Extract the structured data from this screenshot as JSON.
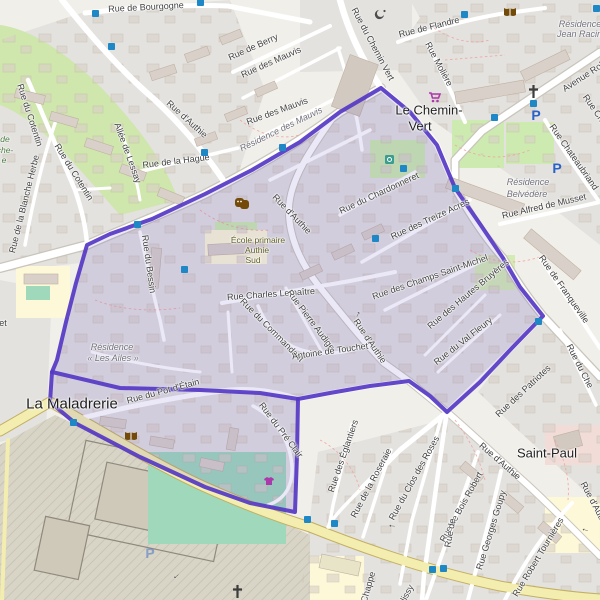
{
  "map_title": "Quartier boundary map (OSM style)",
  "boundary": {
    "stroke": "#5538c5",
    "fill": "rgba(100,80,200,0.14)",
    "outer_points": "381,88 340,112 300,142 252,170 205,194 152,219 110,234 87,245 76,283 66,322 57,360 52,372 50,402 75,423 140,457 205,487 250,503 295,512 297,455 298,399 330,393 370,386 409,381 430,396 447,412 480,382 512,348 543,316 520,287 503,258 480,224 455,188 437,145 410,112",
    "inner_edge_points": "52,372 120,388 200,390 260,393 298,399"
  },
  "labels": [
    {
      "text": "Rue de Bourgogne",
      "x": 146,
      "y": 7,
      "rot": -3,
      "cls": "street"
    },
    {
      "text": "Rue de Berry",
      "x": 253,
      "y": 47,
      "rot": -24,
      "cls": "street"
    },
    {
      "text": "Rue des Mauvis",
      "x": 271,
      "y": 62,
      "rot": -24,
      "cls": "street"
    },
    {
      "text": "Rue des Mauvis",
      "x": 277,
      "y": 111,
      "rot": -20,
      "cls": "street"
    },
    {
      "text": "Résidence des Mauvis",
      "x": 281,
      "y": 129,
      "rot": -26,
      "cls": "residence"
    },
    {
      "text": "Rue du Chemin Vert",
      "x": 373,
      "y": 44,
      "rot": 62,
      "cls": "street"
    },
    {
      "text": "Rue de Flandre",
      "x": 429,
      "y": 27,
      "rot": -14,
      "cls": "street"
    },
    {
      "text": "Rue Molière",
      "x": 439,
      "y": 64,
      "rot": 62,
      "cls": "street"
    },
    {
      "text": "Avenue Rob",
      "x": 584,
      "y": 76,
      "rot": -33,
      "cls": "street"
    },
    {
      "text": "Résidence",
      "x": 580,
      "y": 24,
      "rot": 0,
      "cls": "residence"
    },
    {
      "text": "Jean Racine",
      "x": 582,
      "y": 34,
      "rot": 0,
      "cls": "residence"
    },
    {
      "text": "Rue Chateaubriand",
      "x": 574,
      "y": 157,
      "rot": 55,
      "cls": "street"
    },
    {
      "text": "Rue Charle",
      "x": 598,
      "y": 114,
      "rot": 55,
      "cls": "street"
    },
    {
      "text": "Rue Alfred de Musset",
      "x": 544,
      "y": 206,
      "rot": -13,
      "cls": "street"
    },
    {
      "text": "Résidence",
      "x": 528,
      "y": 182,
      "rot": 0,
      "cls": "residence"
    },
    {
      "text": "Belvédère",
      "x": 527,
      "y": 194,
      "rot": 0,
      "cls": "residence"
    },
    {
      "text": "Rue d'Authie",
      "x": 187,
      "y": 119,
      "rot": 42,
      "cls": "street"
    },
    {
      "text": "Rue de la Hague",
      "x": 176,
      "y": 161,
      "rot": -7,
      "cls": "street"
    },
    {
      "text": "Allée de Lessay",
      "x": 128,
      "y": 153,
      "rot": 70,
      "cls": "street"
    },
    {
      "text": "Rue du Cotentin",
      "x": 30,
      "y": 115,
      "rot": 72,
      "cls": "street"
    },
    {
      "text": "Rue du Cotentin",
      "x": 74,
      "y": 172,
      "rot": 58,
      "cls": "street"
    },
    {
      "text": "Rue de la Blanche Herbe",
      "x": 24,
      "y": 204,
      "rot": -76,
      "cls": "street"
    },
    {
      "text": "Rue du Bessin",
      "x": 149,
      "y": 264,
      "rot": 82,
      "cls": "street"
    },
    {
      "text": "Rue d'Authie",
      "x": 292,
      "y": 214,
      "rot": 46,
      "cls": "street"
    },
    {
      "text": "Rue du Chardonneret",
      "x": 379,
      "y": 193,
      "rot": -25,
      "cls": "street"
    },
    {
      "text": "Rue des Treize Acres",
      "x": 430,
      "y": 219,
      "rot": -25,
      "cls": "street"
    },
    {
      "text": "Rue des Champs Saint-Michel",
      "x": 430,
      "y": 277,
      "rot": -19,
      "cls": "street"
    },
    {
      "text": "Rue des Hautes Bruyères",
      "x": 468,
      "y": 294,
      "rot": -40,
      "cls": "street"
    },
    {
      "text": "Rue du Val Fleury",
      "x": 463,
      "y": 341,
      "rot": -38,
      "cls": "street"
    },
    {
      "text": "Rue Charles Lemaître",
      "x": 271,
      "y": 294,
      "rot": -4,
      "cls": "street"
    },
    {
      "text": "Rue Pierre Audige",
      "x": 311,
      "y": 320,
      "rot": 53,
      "cls": "street"
    },
    {
      "text": "Rue du Commandant",
      "x": 272,
      "y": 330,
      "rot": 45,
      "cls": "street"
    },
    {
      "text": "Antoine de Touchet",
      "x": 330,
      "y": 351,
      "rot": -8,
      "cls": "street"
    },
    {
      "text": "Rue d'Authie",
      "x": 370,
      "y": 341,
      "rot": 56,
      "cls": "street"
    },
    {
      "text": "École primaire",
      "x": 258,
      "y": 240,
      "rot": 0,
      "cls": "school"
    },
    {
      "text": "Authie",
      "x": 257,
      "y": 250,
      "rot": 0,
      "cls": "school"
    },
    {
      "text": "Sud",
      "x": 253,
      "y": 260,
      "rot": 0,
      "cls": "school"
    },
    {
      "text": "Résidence",
      "x": 112,
      "y": 347,
      "rot": 0,
      "cls": "residence"
    },
    {
      "text": "« Les Ailes »",
      "x": 113,
      "y": 358,
      "rot": 0,
      "cls": "residence"
    },
    {
      "text": "Rue du Pot d'Étain",
      "x": 163,
      "y": 391,
      "rot": -15,
      "cls": "street"
    },
    {
      "text": "La Maladrerie",
      "x": 72,
      "y": 404,
      "rot": 0,
      "cls": "place-lg"
    },
    {
      "text": "Le Chemin-",
      "x": 429,
      "y": 110,
      "rot": 0,
      "cls": "place"
    },
    {
      "text": "Vert",
      "x": 420,
      "y": 126,
      "rot": 0,
      "cls": "place"
    },
    {
      "text": "Saint-Paul",
      "x": 547,
      "y": 453,
      "rot": 0,
      "cls": "place"
    },
    {
      "text": "Rue du Pré Clair",
      "x": 281,
      "y": 430,
      "rot": 53,
      "cls": "street"
    },
    {
      "text": "Rue des Églantiers",
      "x": 343,
      "y": 456,
      "rot": -71,
      "cls": "street"
    },
    {
      "text": "Rue de la Roseraie",
      "x": 371,
      "y": 483,
      "rot": -62,
      "cls": "street"
    },
    {
      "text": "Rue du Clos des Roses",
      "x": 414,
      "y": 478,
      "rot": -61,
      "cls": "street"
    },
    {
      "text": "Rue des Patriotes",
      "x": 523,
      "y": 391,
      "rot": -43,
      "cls": "street"
    },
    {
      "text": "Rue de Franqueville",
      "x": 564,
      "y": 289,
      "rot": 55,
      "cls": "street"
    },
    {
      "text": "Rue du Che",
      "x": 580,
      "y": 366,
      "rot": 63,
      "cls": "street"
    },
    {
      "text": "Rue de Bois Robert",
      "x": 461,
      "y": 507,
      "rot": -61,
      "cls": "street"
    },
    {
      "text": "Rue Georges Goupy",
      "x": 491,
      "y": 530,
      "rot": -73,
      "cls": "street"
    },
    {
      "text": "Rue Robert Tournières",
      "x": 538,
      "y": 557,
      "rot": -59,
      "cls": "street"
    },
    {
      "text": "Rue d'Authie",
      "x": 500,
      "y": 461,
      "rot": 41,
      "cls": "street"
    },
    {
      "text": "Rue d'Authie",
      "x": 595,
      "y": 505,
      "rot": 62,
      "cls": "street"
    },
    {
      "text": "Chappe",
      "x": 368,
      "y": 587,
      "rot": -74,
      "cls": "street"
    },
    {
      "text": "lissy",
      "x": 407,
      "y": 593,
      "rot": -62,
      "cls": "street"
    },
    {
      "text": "Rue de",
      "x": 450,
      "y": 533,
      "rot": -80,
      "cls": "street"
    },
    {
      "text": "de",
      "x": 5,
      "y": 139,
      "rot": 0,
      "cls": "park"
    },
    {
      "text": "che-",
      "x": 5,
      "y": 150,
      "rot": 0,
      "cls": "park"
    },
    {
      "text": "e",
      "x": 4,
      "y": 160,
      "rot": 0,
      "cls": "park"
    },
    {
      "text": "et",
      "x": 3,
      "y": 323,
      "rot": 0,
      "cls": "street"
    }
  ],
  "bus_stops": [
    [
      95,
      13
    ],
    [
      200,
      2
    ],
    [
      111,
      46
    ],
    [
      464,
      14
    ],
    [
      596,
      8
    ],
    [
      282,
      147
    ],
    [
      204,
      152
    ],
    [
      137,
      224
    ],
    [
      184,
      269
    ],
    [
      375,
      238
    ],
    [
      403,
      168
    ],
    [
      455,
      188
    ],
    [
      533,
      103
    ],
    [
      494,
      117
    ],
    [
      538,
      321
    ],
    [
      73,
      422
    ],
    [
      307,
      519
    ],
    [
      334,
      523
    ],
    [
      432,
      569
    ],
    [
      443,
      568
    ]
  ],
  "icons": [
    {
      "type": "church",
      "x": 527,
      "y": 84
    },
    {
      "type": "church",
      "x": 231,
      "y": 584
    },
    {
      "type": "library",
      "x": 503,
      "y": 7
    },
    {
      "type": "library",
      "x": 124,
      "y": 431
    },
    {
      "type": "theatre",
      "x": 235,
      "y": 198
    },
    {
      "type": "supermarket",
      "x": 428,
      "y": 92
    },
    {
      "type": "mosque",
      "x": 374,
      "y": 8
    },
    {
      "type": "parking",
      "x": 536,
      "y": 115,
      "label": "P"
    },
    {
      "type": "parking",
      "x": 557,
      "y": 168,
      "label": "P"
    },
    {
      "type": "parking",
      "x": 150,
      "y": 553,
      "label": "P",
      "faint": true
    },
    {
      "type": "clothes-shop",
      "x": 263,
      "y": 476
    },
    {
      "type": "recycling",
      "x": 385,
      "y": 155
    }
  ],
  "oneway_arrows": [
    {
      "x": 357,
      "y": 314,
      "rot": -65
    },
    {
      "x": 513,
      "y": 477,
      "rot": 215
    },
    {
      "x": 585,
      "y": 531,
      "rot": 195
    },
    {
      "x": 392,
      "y": 527,
      "rot": 185
    },
    {
      "x": 177,
      "y": 577,
      "rot": 140
    }
  ]
}
